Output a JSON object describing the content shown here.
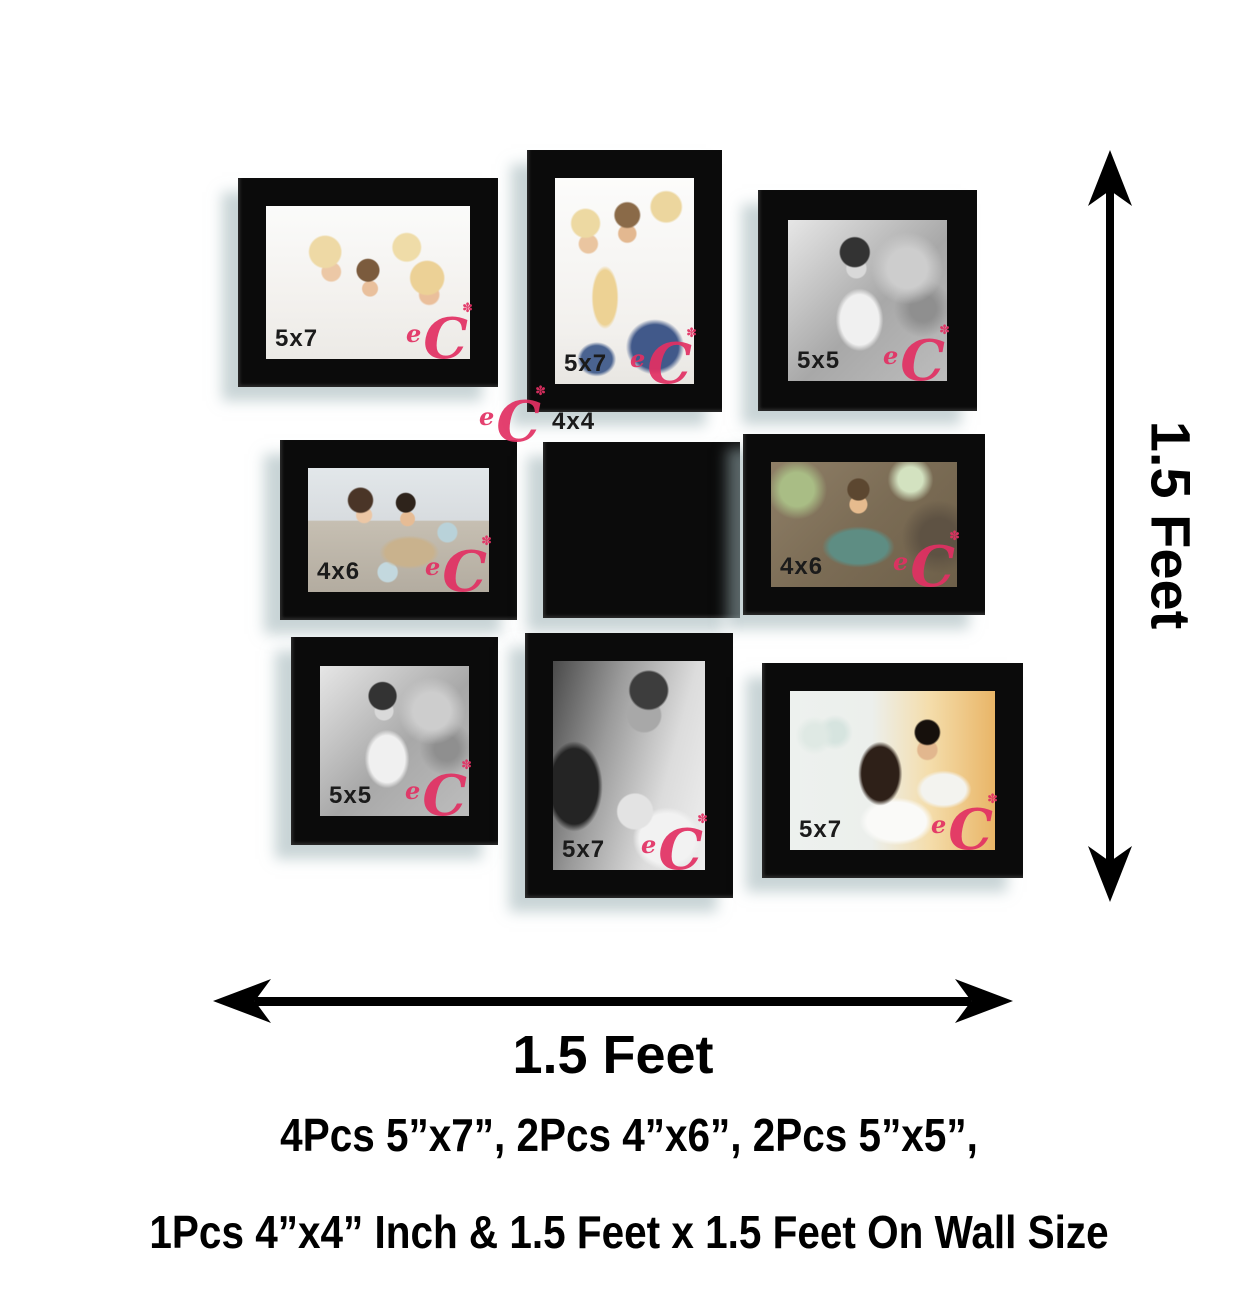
{
  "colors": {
    "background": "#ffffff",
    "frame": "#0b0b0b",
    "label": "#1b1b1b",
    "logo": "#e23063",
    "annotation": "#000000"
  },
  "logo": {
    "e": "e",
    "c": "C",
    "spark": "✽"
  },
  "frames": [
    {
      "label": "5x7",
      "position": "top-left",
      "orientation": "landscape",
      "photo": "family-of-four-on-bed"
    },
    {
      "label": "5x7",
      "position": "top-center",
      "orientation": "portrait",
      "photo": "family-of-four-seated"
    },
    {
      "label": "5x5",
      "position": "top-right",
      "orientation": "square",
      "photo": "baby-black-and-white"
    },
    {
      "label": "4x6",
      "position": "middle-left",
      "orientation": "landscape",
      "photo": "couple-with-coffee-mugs"
    },
    {
      "label": "4x4",
      "position": "middle-center",
      "orientation": "square",
      "photo": "young-couple-warm-wall"
    },
    {
      "label": "4x6",
      "position": "middle-right",
      "orientation": "landscape",
      "photo": "boy-climbing-tree"
    },
    {
      "label": "5x5",
      "position": "bottom-left",
      "orientation": "square",
      "photo": "baby-black-and-white"
    },
    {
      "label": "5x7",
      "position": "bottom-center",
      "orientation": "portrait",
      "photo": "parents-kissing-baby-black-and-white"
    },
    {
      "label": "5x7",
      "position": "bottom-right",
      "orientation": "landscape",
      "photo": "couple-in-kitchen"
    }
  ],
  "dimensions": {
    "vertical_label": "1.5 Feet",
    "horizontal_label": "1.5 Feet"
  },
  "caption": {
    "line1": "4Pcs 5”x7”, 2Pcs 4”x6”, 2Pcs 5”x5”,",
    "line2": "1Pcs 4”x4” Inch & 1.5 Feet x 1.5 Feet On Wall Size"
  }
}
